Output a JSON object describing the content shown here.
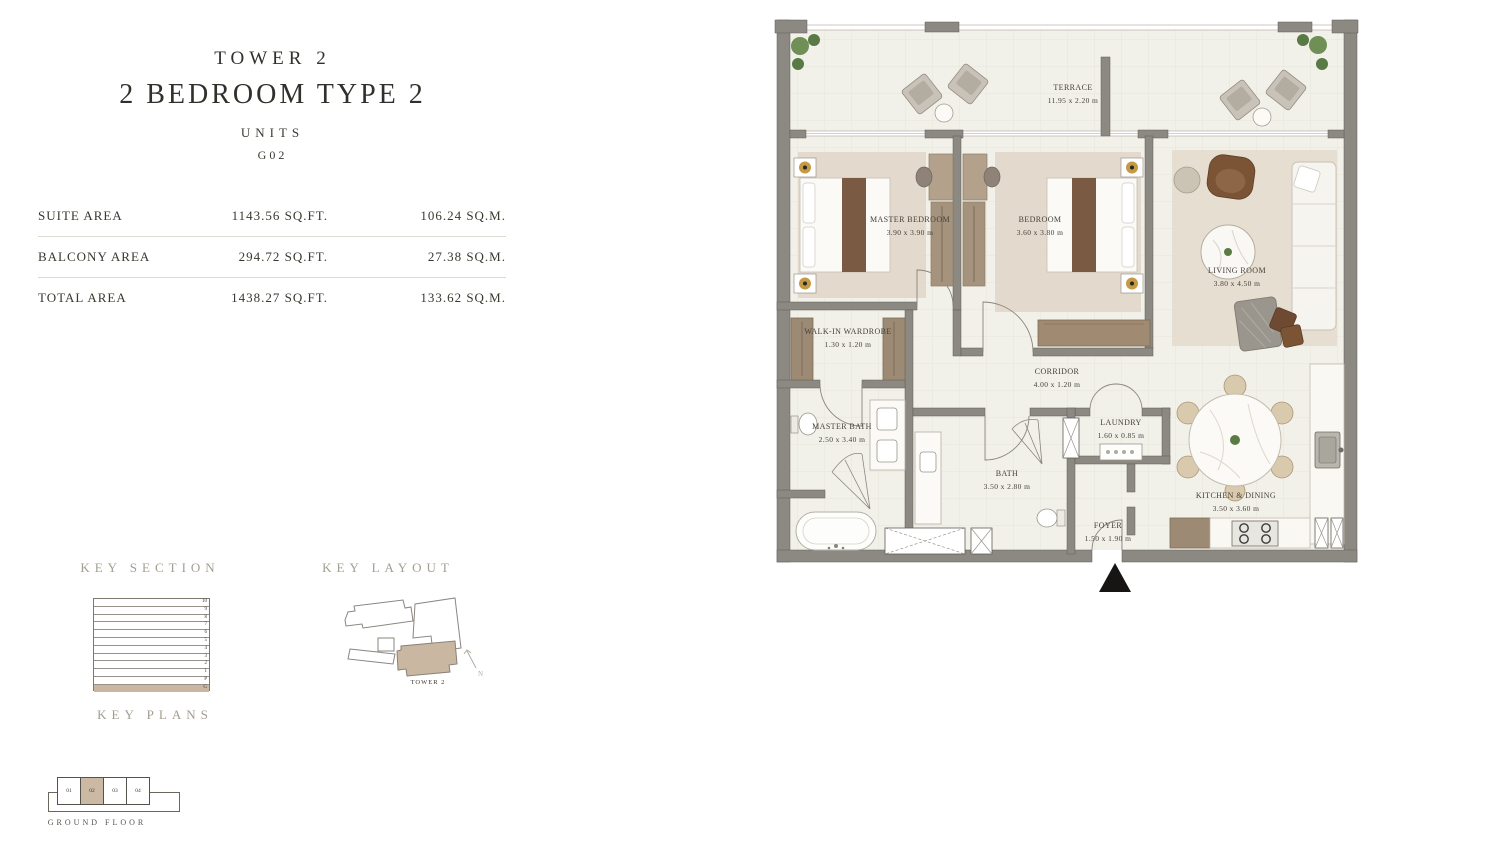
{
  "header": {
    "tower": "TOWER 2",
    "type": "2 BEDROOM TYPE 2",
    "units_label": "UNITS",
    "unit_number": "G02"
  },
  "areas": {
    "rows": [
      {
        "label": "SUITE AREA",
        "sqft": "1143.56 SQ.FT.",
        "sqm": "106.24 SQ.M."
      },
      {
        "label": "BALCONY AREA",
        "sqft": "294.72 SQ.FT.",
        "sqm": "27.38 SQ.M."
      },
      {
        "label": "TOTAL AREA",
        "sqft": "1438.27 SQ.FT.",
        "sqm": "133.62 SQ.M."
      }
    ]
  },
  "key_section": {
    "title": "KEY SECTION",
    "levels": [
      "10",
      "9",
      "8",
      "7",
      "6",
      "5",
      "4",
      "3",
      "2",
      "1",
      "P",
      "G"
    ],
    "highlighted_level": "G"
  },
  "key_layout": {
    "title": "KEY LAYOUT",
    "tower_label": "TOWER 2",
    "north_label": "N"
  },
  "key_plans": {
    "title": "KEY PLANS",
    "units": [
      "01",
      "02",
      "03",
      "04"
    ],
    "highlighted_unit": "02",
    "floor_label": "GROUND FLOOR"
  },
  "floor_plan": {
    "rooms": [
      {
        "name": "TERRACE",
        "dims": "11.95 x 2.20 m"
      },
      {
        "name": "MASTER BEDROOM",
        "dims": "3.90 x 3.90 m"
      },
      {
        "name": "BEDROOM",
        "dims": "3.60 x 3.80 m"
      },
      {
        "name": "LIVING ROOM",
        "dims": "3.80 x 4.50 m"
      },
      {
        "name": "WALK-IN WARDROBE",
        "dims": "1.30 x 1.20 m"
      },
      {
        "name": "CORRIDOR",
        "dims": "4.00 x 1.20 m"
      },
      {
        "name": "MASTER BATH",
        "dims": "2.50 x 3.40 m"
      },
      {
        "name": "BATH",
        "dims": "3.50 x 2.80 m"
      },
      {
        "name": "LAUNDRY",
        "dims": "1.60 x 0.85 m"
      },
      {
        "name": "KITCHEN & DINING",
        "dims": "3.50 x 3.60 m"
      },
      {
        "name": "FOYER",
        "dims": "1.50 x 1.90 m"
      }
    ]
  },
  "colors": {
    "accent_tan": "#c9b7a2",
    "wall_gray": "#8c8982",
    "floor_cream": "#f2f1e9",
    "wood": "#9c8a74",
    "text_dark": "#32302b"
  }
}
